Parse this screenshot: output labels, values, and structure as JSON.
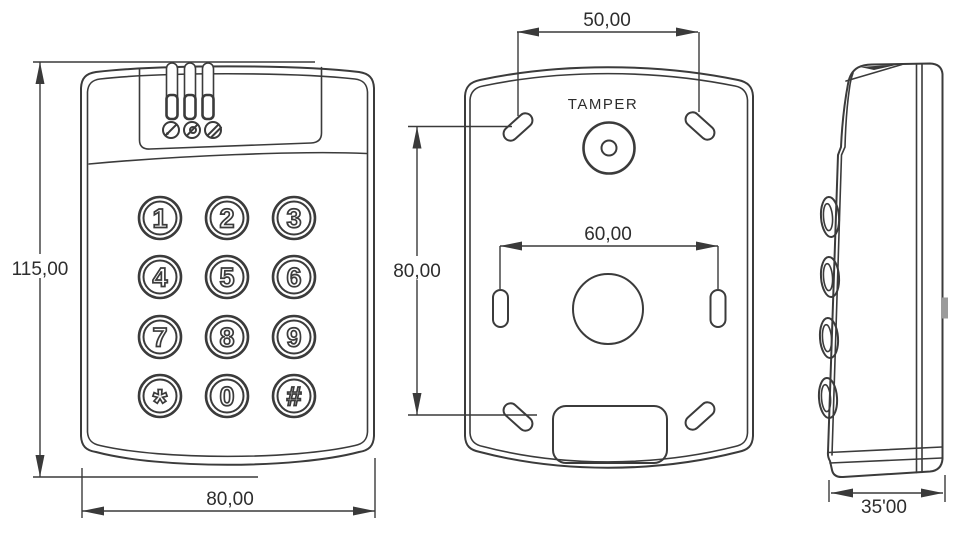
{
  "colors": {
    "background": "#ffffff",
    "line": "#3b3b3b",
    "text": "#2d2d2d",
    "side_tab": "#9b9b9b"
  },
  "front_view": {
    "dim_height": "115,00",
    "dim_width": "80,00",
    "leds": [
      "led-indicator-1",
      "led-indicator-2",
      "led-indicator-3"
    ],
    "status_icons": [
      "status-icon-1",
      "status-icon-2",
      "status-icon-3"
    ],
    "keypad": {
      "buttons": [
        "1",
        "2",
        "3",
        "4",
        "5",
        "6",
        "7",
        "8",
        "9",
        "*",
        "0",
        "#"
      ]
    }
  },
  "back_view": {
    "tamper_label": "TAMPER",
    "dim_top_hole_spacing": "50,00",
    "dim_mid_hole_spacing": "60,00",
    "dim_hole_vertical_spacing": "80,00"
  },
  "side_view": {
    "dim_depth": "35'00"
  }
}
